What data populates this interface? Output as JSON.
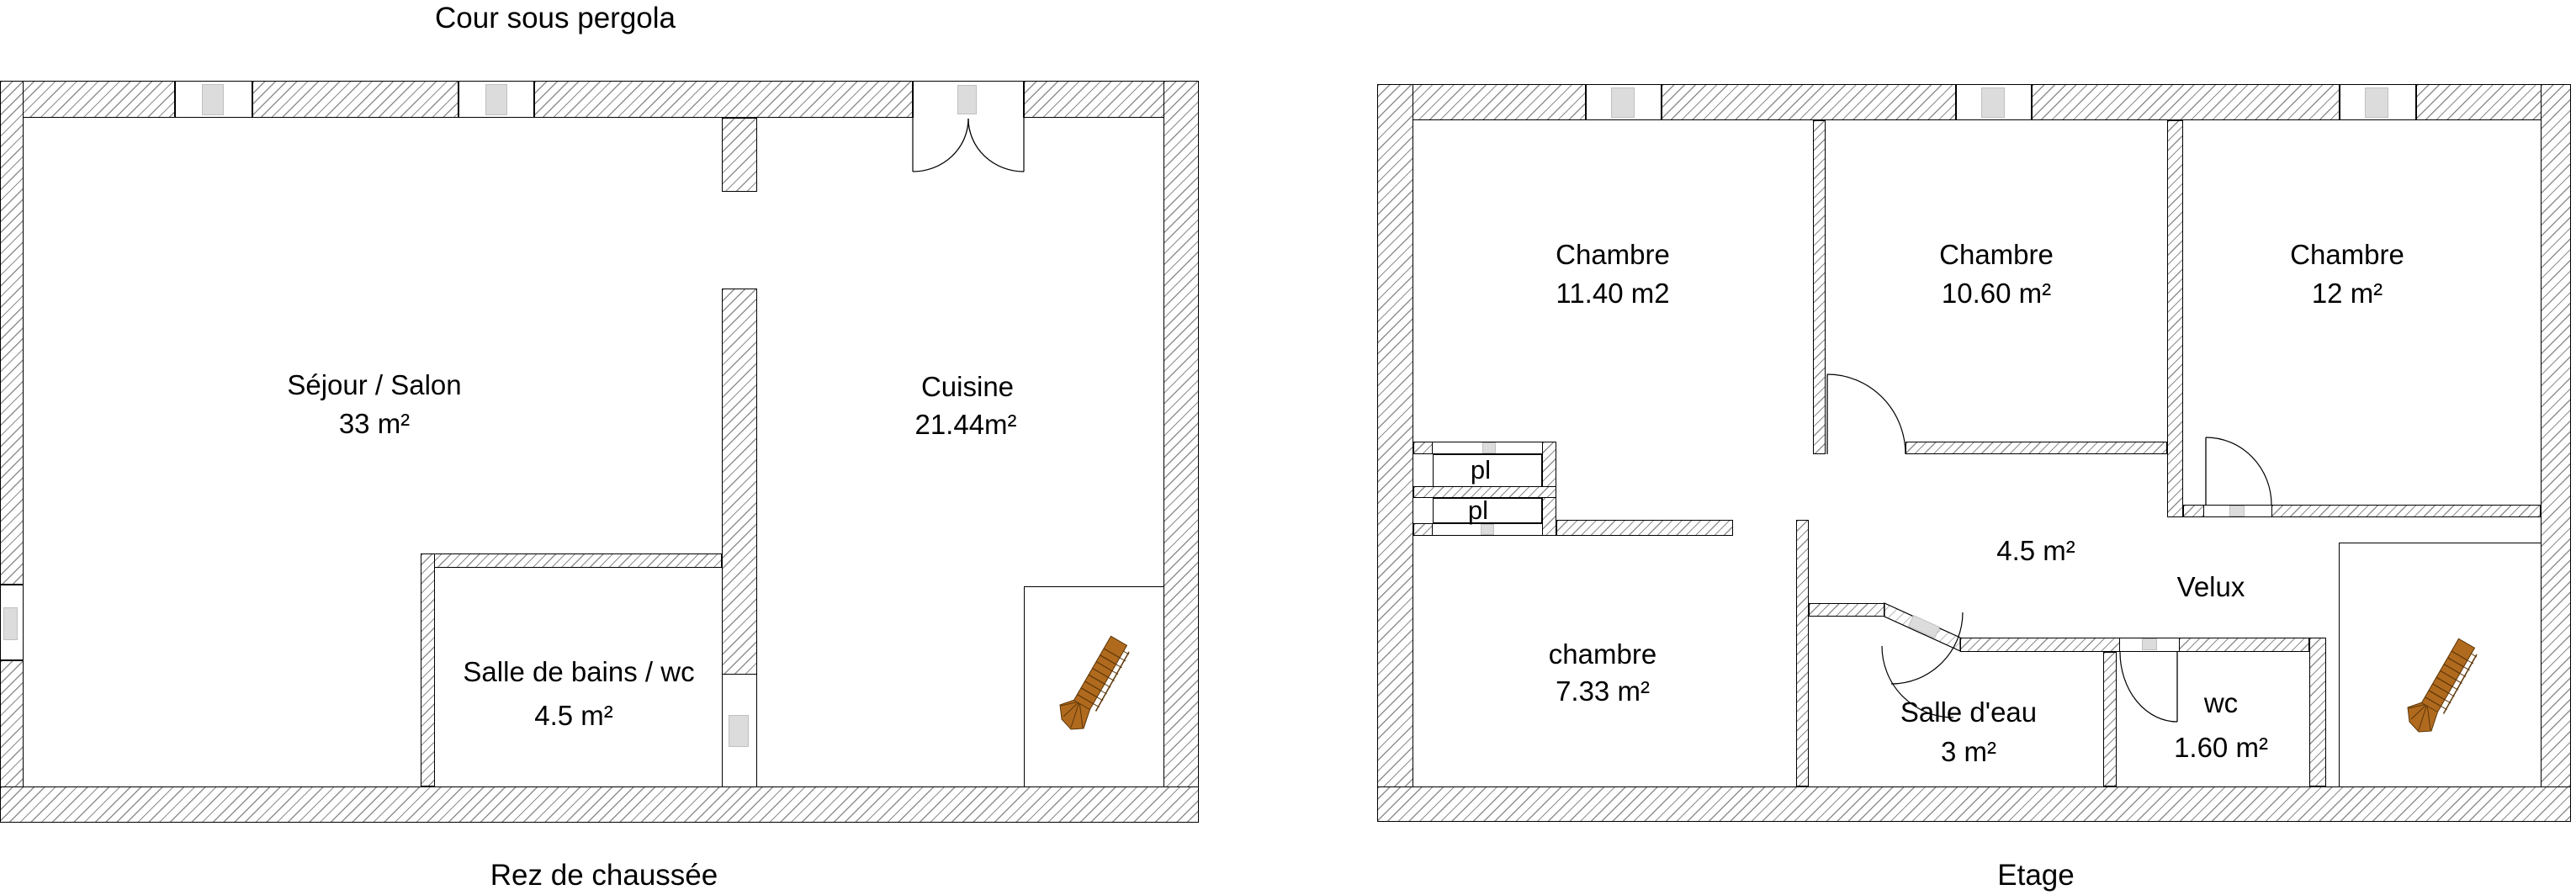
{
  "captions": {
    "courtyard": "Cour sous pergola",
    "ground_floor": "Rez de chaussée",
    "upper_floor": "Etage"
  },
  "colors": {
    "wall_border": "#000000",
    "wall_hatch": "#8f8f8f",
    "fixture_gray": "#dcdcdc",
    "stair_wood": "#b06a1e",
    "stair_wood_dark": "#5c3608"
  },
  "ground_floor": {
    "rooms": [
      {
        "key": "sejour",
        "name": "Séjour / Salon",
        "area": "33 m²"
      },
      {
        "key": "cuisine",
        "name": "Cuisine",
        "area": "21.44m²"
      },
      {
        "key": "bath",
        "name": "Salle de bains / wc",
        "area": "4.5 m²"
      }
    ]
  },
  "upper_floor": {
    "rooms": [
      {
        "key": "chambre1",
        "name": "Chambre",
        "area": "11.40 m2"
      },
      {
        "key": "chambre2",
        "name": "Chambre",
        "area": "10.60 m²"
      },
      {
        "key": "chambre3",
        "name": "Chambre",
        "area": "12 m²"
      },
      {
        "key": "chambre4",
        "name": "chambre",
        "area": "7.33 m²"
      },
      {
        "key": "sde",
        "name": "Salle d'eau",
        "area": "3 m²"
      },
      {
        "key": "wc",
        "name": "wc",
        "area": "1.60 m²"
      }
    ],
    "labels": {
      "landing_area": "4.5 m²",
      "velux": "Velux",
      "closet1": "pl",
      "closet2": "pl"
    }
  }
}
